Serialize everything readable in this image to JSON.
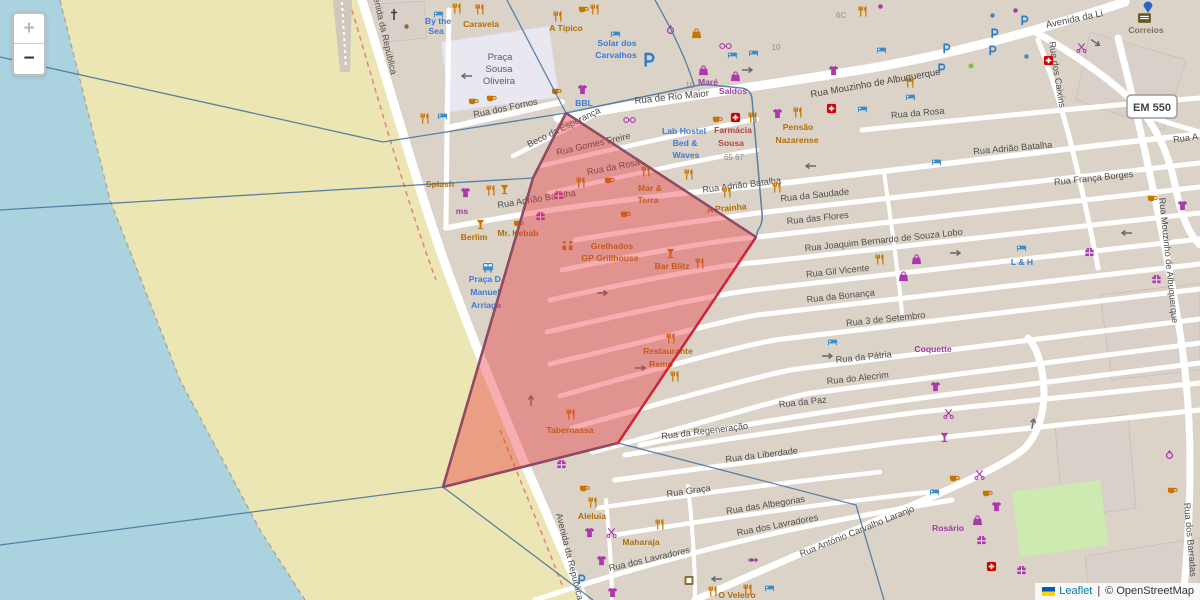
{
  "controls": {
    "zoom_in": "+",
    "zoom_out": "−"
  },
  "attribution": {
    "leaflet": "Leaflet",
    "sep": "|",
    "copyright": "© OpenStreetMap"
  },
  "badge": {
    "em550": "EM 550"
  },
  "praca": {
    "l1": "Praça",
    "l2": "Sousa",
    "l3": "Oliveira"
  },
  "streets": [
    {
      "t": "Avenida da República"
    },
    {
      "t": "Rua dos Fornos"
    },
    {
      "t": "Beco da Esperança"
    },
    {
      "t": "Rua Gomes Freire"
    },
    {
      "t": "Rua de Rio Maior"
    },
    {
      "t": "Rua Mouzinho de Albuquerque"
    },
    {
      "t": "Avenida da Li"
    },
    {
      "t": "Rua da Rosa"
    },
    {
      "t": "Rua Adrião Batalha"
    },
    {
      "t": "Rua França Borges"
    },
    {
      "t": "Rua A"
    },
    {
      "t": "Rua dos Caixins"
    },
    {
      "t": "Rua da Rosa"
    },
    {
      "t": "Rua Adrião Batalha"
    },
    {
      "t": "Rua Adrião Batalha"
    },
    {
      "t": "Rua da Saudade"
    },
    {
      "t": "Rua das Flores"
    },
    {
      "t": "Rua Joaquim Bernardo de Souza Lobo"
    },
    {
      "t": "Rua Gil Vicente"
    },
    {
      "t": "Rua da Bonança"
    },
    {
      "t": "Rua 3 de Setembro"
    },
    {
      "t": "Rua da Pátria"
    },
    {
      "t": "Rua do Alecrim"
    },
    {
      "t": "Rua da Paz"
    },
    {
      "t": "Rua da Regeneração"
    },
    {
      "t": "Rua da Liberdade"
    },
    {
      "t": "Rua Graça"
    },
    {
      "t": "Rua das Albegorias"
    },
    {
      "t": "Rua dos Lavradores"
    },
    {
      "t": "Rua dos Lavradores"
    },
    {
      "t": "Rua António Carvalho Laranjo"
    },
    {
      "t": "Rua Mouzinho de Albuquerque"
    },
    {
      "t": "Rua dos Barradas"
    },
    {
      "t": "Avenida da República"
    }
  ],
  "pois": [
    {
      "l1": "By the",
      "l2": "Sea"
    },
    {
      "l1": "Caravela"
    },
    {
      "l1": "A Típico"
    },
    {
      "l1": "Solar dos",
      "l2": "Carvalhos"
    },
    {
      "l1": "Maré",
      "l2": "Saldos"
    },
    {
      "l1": "Lab Hostel",
      "l2": "Bed &",
      "l3": "Waves"
    },
    {
      "l1": "Farmácia",
      "l2": "Sousa"
    },
    {
      "l1": "Pensão",
      "l2": "Nazarense"
    },
    {
      "l1": "Mar &",
      "l2": "Terra"
    },
    {
      "l1": "A Prainha"
    },
    {
      "l1": "Grelhados",
      "l2": "GP Grillhouse"
    },
    {
      "l1": "Bar Blitz"
    },
    {
      "l1": "Restaurante",
      "l2": "Remo"
    },
    {
      "l1": "Tabernassa"
    },
    {
      "l1": "Splash"
    },
    {
      "l1": "ms"
    },
    {
      "l1": "Berlim"
    },
    {
      "l1": "Mr. Kebab"
    },
    {
      "l1": "Praça D.",
      "l2": "Manuel",
      "l3": "Arriaga"
    },
    {
      "l1": "Aleluia"
    },
    {
      "l1": "Maharaja"
    },
    {
      "l1": "O Veleiro"
    },
    {
      "l1": "Coquette"
    },
    {
      "l1": "Rosário"
    },
    {
      "l1": "Correios"
    },
    {
      "l1": "L & H"
    },
    {
      "l1": "BBL"
    }
  ],
  "numbers": [
    "10",
    "10",
    "6C",
    "65 67"
  ],
  "colors": {
    "water": "#aad3df",
    "sand": "#ece5b4",
    "selection_fill": "#e8353c",
    "selection_stroke": "#cf2433",
    "boundary_blue": "#41719c",
    "park": "#cdebb0"
  }
}
